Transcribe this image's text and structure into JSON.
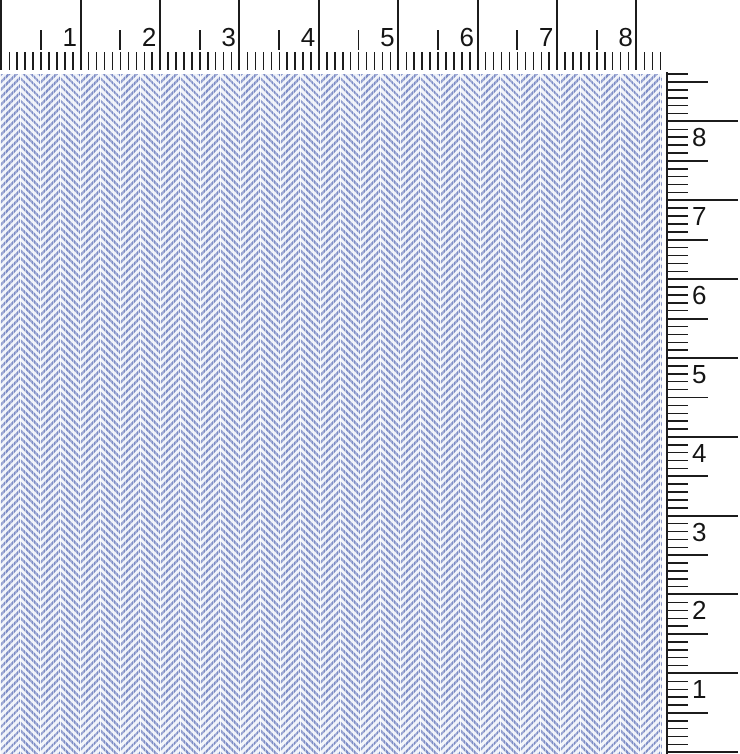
{
  "scene": {
    "description": "Scanned swatch of light blue-and-white herringbone twill fabric with a horizontal ruler along the top edge and a vertical ruler along the right edge"
  },
  "top_ruler": {
    "numbers": [
      "1",
      "2",
      "3",
      "4",
      "5",
      "6",
      "7",
      "8"
    ]
  },
  "right_ruler": {
    "numbers": [
      "8",
      "7",
      "6",
      "5",
      "4",
      "3",
      "2",
      "1"
    ]
  },
  "colors": {
    "ruler_background": "#ffffff",
    "tick": "#1c1c1c",
    "number_text": "#151515",
    "fabric_yarn_blue": "#7d8cc5",
    "fabric_ground": "#eef1f8",
    "fabric_seam_white": "#ffffff"
  },
  "geometry": {
    "top": {
      "origin_x": 0.6,
      "mm_step": 7.94,
      "mm_count": 83,
      "cm_line_height": 70,
      "half_top": 30,
      "half_height": 20,
      "band_top": 52,
      "band_height": 18,
      "number_top": 24,
      "number_width": 34,
      "number_gap": 3
    },
    "right": {
      "origin_y": 752.2,
      "mm_step": 7.886,
      "mm_count": 86,
      "baseline_x": 666,
      "baseline_top": 72,
      "cm_length": 71,
      "half_length": 41,
      "mm_length": 21,
      "number_left": 692,
      "number_offset": 3
    },
    "fabric": {
      "left": 0,
      "top": 74,
      "width": 662,
      "height": 680,
      "column_width": 20,
      "column_count": 34,
      "stripe_width": 2.4,
      "stripe_period": 5.3
    }
  }
}
